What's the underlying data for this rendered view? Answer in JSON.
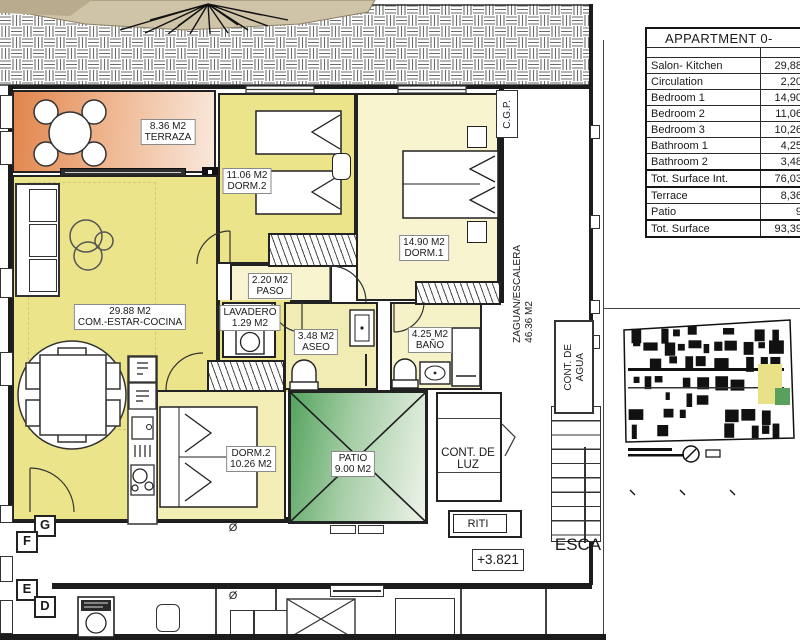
{
  "colors": {
    "wall": "#1c1c1c",
    "room_yellow": "#ebe48a",
    "room_pale": "#f7f4cf",
    "terrace_orange": "#e2854d",
    "patio_green": "#55a45f"
  },
  "area_table": {
    "title": "APPARTMENT 0-",
    "rows": [
      {
        "label": "Salon- Kitchen",
        "value": "29,88",
        "emphasis": false
      },
      {
        "label": "Circulation",
        "value": "2,20",
        "emphasis": false
      },
      {
        "label": "Bedroom 1",
        "value": "14,90",
        "emphasis": false
      },
      {
        "label": "Bedroom 2",
        "value": "11,06",
        "emphasis": false
      },
      {
        "label": "Bedroom 3",
        "value": "10,26",
        "emphasis": false
      },
      {
        "label": "Bathroom 1",
        "value": "4,25",
        "emphasis": false
      },
      {
        "label": "Bathroom 2",
        "value": "3,48",
        "emphasis": false
      },
      {
        "label": "Tot. Surface Int.",
        "value": "76,03",
        "emphasis": true
      },
      {
        "label": "Terrace",
        "value": "8,36",
        "emphasis": false
      },
      {
        "label": "Patio",
        "value": "9",
        "emphasis": false
      },
      {
        "label": "Tot. Surface",
        "value": "93,39",
        "emphasis": true
      }
    ]
  },
  "rooms": {
    "terraza": {
      "area": "8.36 M2",
      "name": "TERRAZA"
    },
    "salon": {
      "area": "29.88 M2",
      "name": "COM.-ESTAR-COCINA"
    },
    "dorm2": {
      "area": "11.06 M2",
      "name": "DORM.2"
    },
    "dorm1": {
      "area": "14.90 M2",
      "name": "DORM.1"
    },
    "paso": {
      "area": "2.20 M2",
      "name": "PASO"
    },
    "lavadero": {
      "name": "LAVADERO",
      "area": "1.29 M2"
    },
    "aseo": {
      "area": "3.48 M2",
      "name": "ASEO"
    },
    "bano": {
      "area": "4.25 M2",
      "name": "BAÑO"
    },
    "dorm3": {
      "name": "DORM.2",
      "area": "10.26 M2"
    },
    "patio": {
      "name": "PATIO",
      "area": "9.00 M2"
    },
    "cont_luz": {
      "line1": "CONT. DE",
      "line2": "LUZ"
    },
    "riti": {
      "name": "RITI"
    }
  },
  "annotations": {
    "cgp": "C.G.P.",
    "zaguan_name": "ZAGUAN/ESCALERA",
    "zaguan_area": "46.36 M2",
    "cont_agua_line1": "CONT. DE",
    "cont_agua_line2": "AGUA",
    "esca": "ESCA",
    "level": "+3.821",
    "diameter": "Ø"
  },
  "grid_labels": [
    "G",
    "F",
    "E",
    "D"
  ]
}
